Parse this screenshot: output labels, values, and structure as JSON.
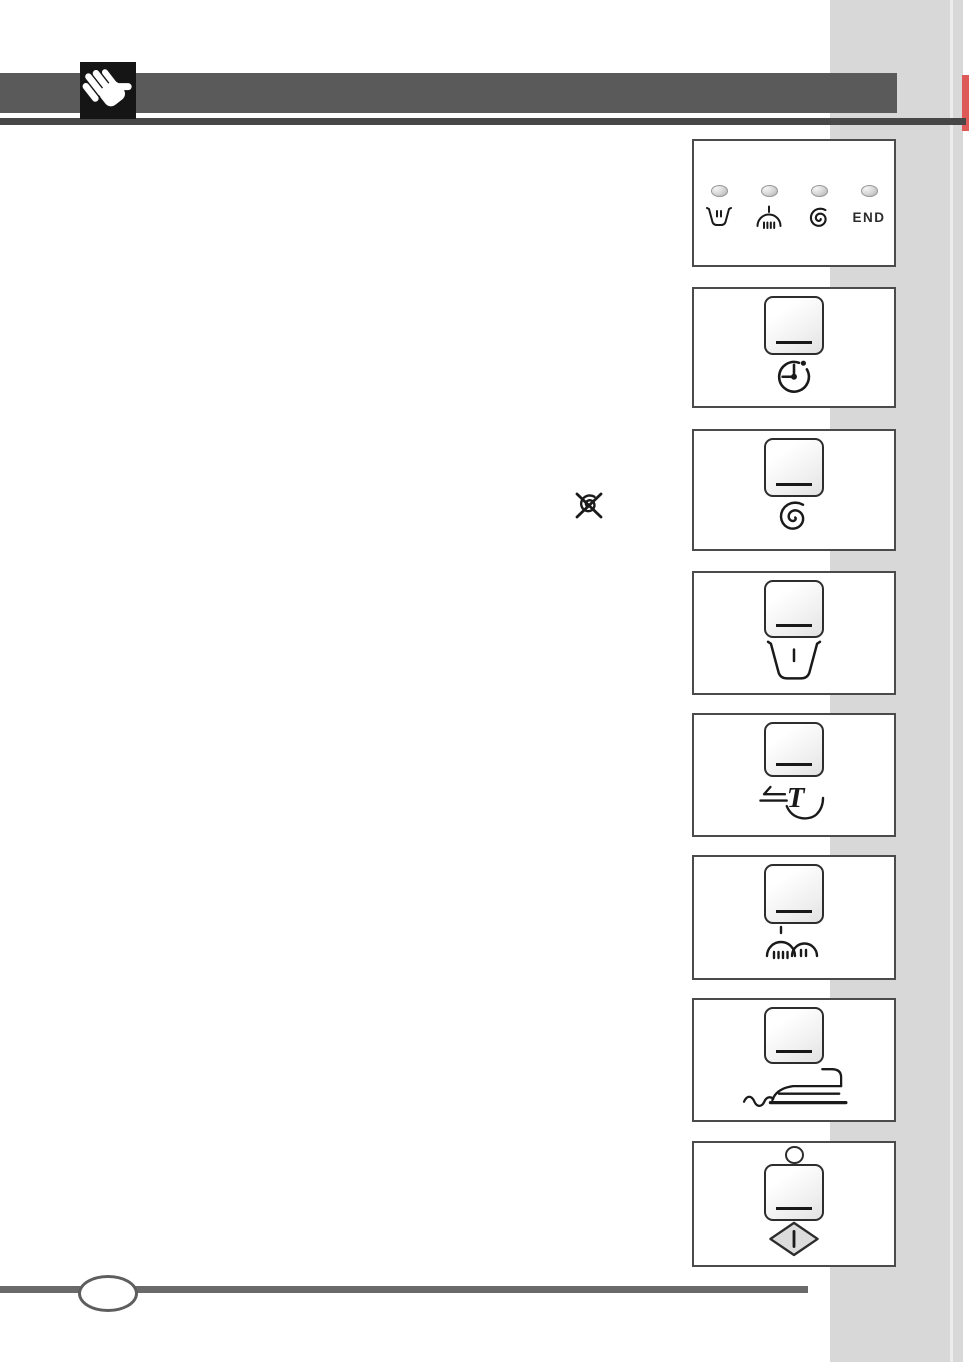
{
  "document": {
    "type": "washing-machine-manual-page",
    "visible_text": [
      "END"
    ]
  },
  "indicator_panel": {
    "leds": [
      {
        "name": "wash-pause-led",
        "icon": "tub-pause-icon",
        "label": ""
      },
      {
        "name": "rinse-led",
        "icon": "rinse-dome-icon",
        "label": ""
      },
      {
        "name": "spin-led",
        "icon": "spin-spiral-icon",
        "label": ""
      },
      {
        "name": "end-led",
        "icon": "end-text",
        "label": "END"
      }
    ]
  },
  "buttons": [
    {
      "name": "delay-start-button",
      "icon": "clock-delay-icon"
    },
    {
      "name": "spin-reduction-button",
      "icon": "spiral-spin-icon"
    },
    {
      "name": "rinse-hold-button",
      "icon": "tub-hold-icon"
    },
    {
      "name": "quick-time-button",
      "icon": "time-t-icon"
    },
    {
      "name": "extra-rinse-button",
      "icon": "double-rinse-icon"
    },
    {
      "name": "easy-iron-button",
      "icon": "iron-icon"
    },
    {
      "name": "start-pause-button",
      "icon": "start-diamond-icon",
      "led": "round-led"
    }
  ],
  "inline": {
    "no_spin_icon": "crossed-spiral-no-spin-icon"
  },
  "header": {
    "hand_icon": "hand-icon"
  },
  "colors": {
    "header_bar": "#5a5a5a",
    "top_rule": "#474747",
    "hand_tile": "#151515",
    "gray_band": "#d8d8d8",
    "red_tab": "#dd5a58",
    "box_border": "#4b4b4b",
    "footer_rule": "#6a6a6a"
  },
  "footer": {
    "page_badge_label": ""
  }
}
